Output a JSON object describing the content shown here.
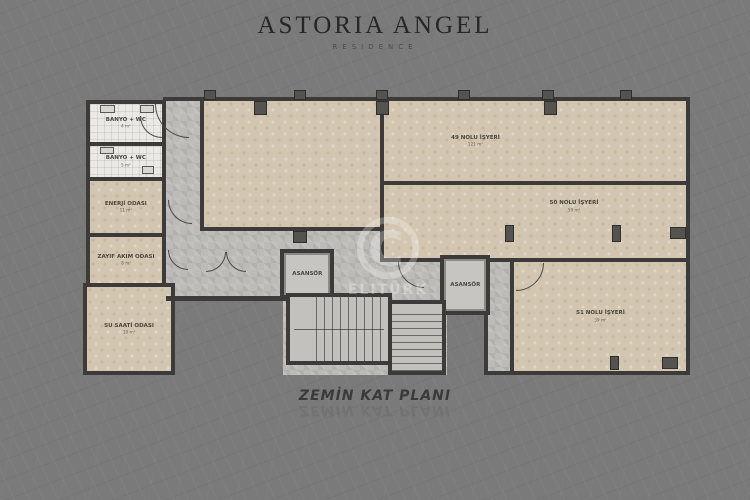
{
  "header": {
    "title": "ASTORIA ANGEL",
    "subtitle": "RESIDENCE"
  },
  "caption": {
    "text": "ZEMİN KAT PLANI",
    "reflection": "ZEMİN KAT PLANI"
  },
  "watermark": {
    "symbol": "©",
    "text": "ELITÜRK"
  },
  "rooms": [
    {
      "name": "BANYO + WC",
      "area": "4 m²"
    },
    {
      "name": "BANYO + WC",
      "area": "5 m²"
    },
    {
      "name": "ENERJİ ODASI",
      "area": "11 m²"
    },
    {
      "name": "ZAYIF AKIM ODASI",
      "area": "8 m²"
    },
    {
      "name": "SU SAATİ ODASI",
      "area": "10 m²"
    },
    {
      "name": "49 NOLU İŞYERİ",
      "area": "121 m²"
    },
    {
      "name": "50 NOLU İŞYERİ",
      "area": "59 m²"
    },
    {
      "name": "51 NOLU İŞYERİ",
      "area": "59 m²"
    }
  ],
  "elevators": [
    {
      "label": "ASANSÖR"
    },
    {
      "label": "ASANSÖR"
    }
  ],
  "colors": {
    "background": "#7a7a7a",
    "wall": "#3c3b39",
    "office_floor": "#d3c6b1",
    "corridor_floor": "#bcbbb7",
    "bath_tile": "#eae9e5",
    "title_text": "#262626",
    "caption_text": "#3a3a3a"
  }
}
